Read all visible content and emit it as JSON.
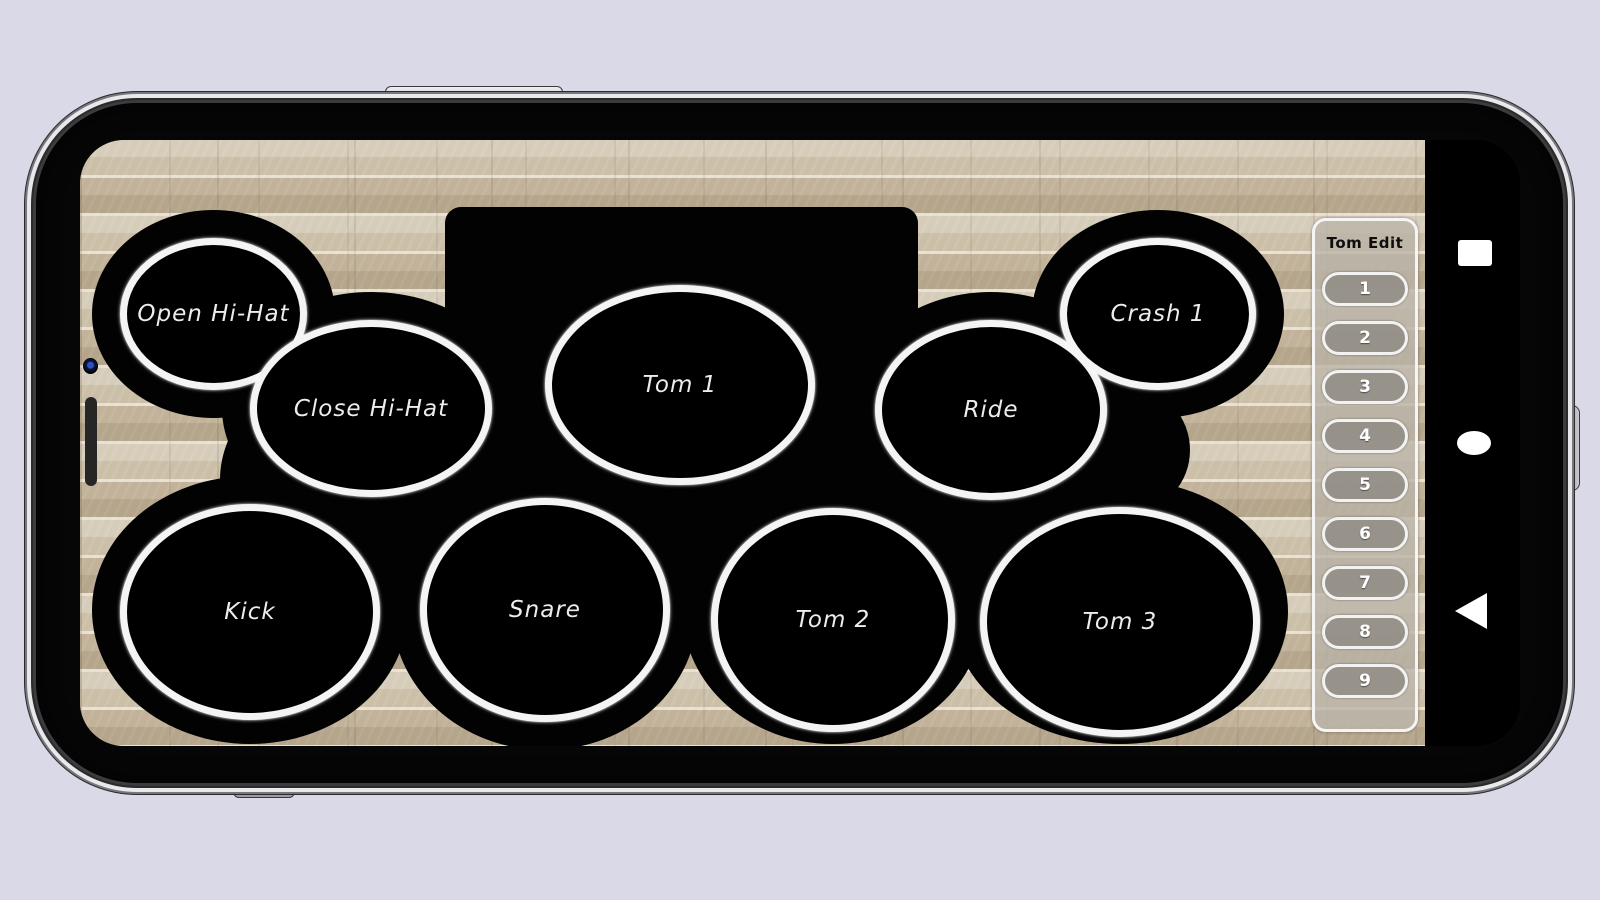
{
  "app": {
    "pads": [
      {
        "label": "Open Hi-Hat"
      },
      {
        "label": "Close Hi-Hat"
      },
      {
        "label": "Tom 1"
      },
      {
        "label": "Ride"
      },
      {
        "label": "Crash 1"
      },
      {
        "label": "Kick"
      },
      {
        "label": "Snare"
      },
      {
        "label": "Tom 2"
      },
      {
        "label": "Tom 3"
      }
    ],
    "edit_panel": {
      "title": "Tom Edit",
      "buttons": [
        "1",
        "2",
        "3",
        "4",
        "5",
        "6",
        "7",
        "8",
        "9"
      ]
    },
    "navigation": {
      "recents_icon": "recents-square",
      "home_icon": "home-circle",
      "back_icon": "back-triangle"
    }
  },
  "colors": {
    "page_background": "#d9d9e7",
    "wall_base": "#c9bda6",
    "wall_mortar": "#e8e1d2",
    "drum_body": "#020202",
    "pad_border": "#f4f4f4",
    "pad_label": "#ececec",
    "panel_fill": "rgba(186,180,168,0.78)",
    "panel_border": "#f5f5f5",
    "button_fill": "rgba(146,142,134,0.9)",
    "nav_icon": "#ffffff",
    "frame_silver": "#e9e9ec"
  }
}
